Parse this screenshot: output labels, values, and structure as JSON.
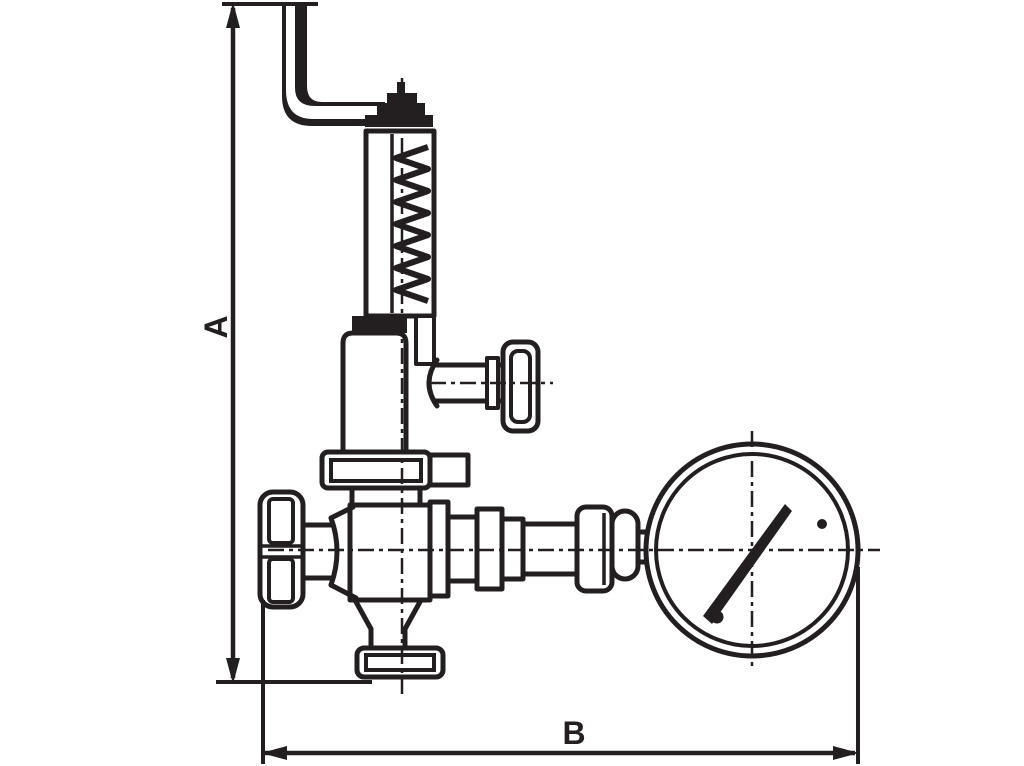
{
  "drawing": {
    "kind": "technical-line-drawing",
    "subject": "safety relief valve with lifting lever, shut-off handwheels and pressure gauge",
    "background_color": "#ffffff",
    "line_color": "#231f20",
    "labels": {
      "dim_vertical": "A",
      "dim_horizontal": "B"
    },
    "parts": [
      "lifting-lever",
      "spindle-cap-nut",
      "spring-housing",
      "spring",
      "bonnet",
      "side-handwheel",
      "mid-flange",
      "valve-body",
      "front-handwheel",
      "outlet-flange",
      "pipe-union",
      "pressure-gauge",
      "gauge-needle"
    ]
  }
}
